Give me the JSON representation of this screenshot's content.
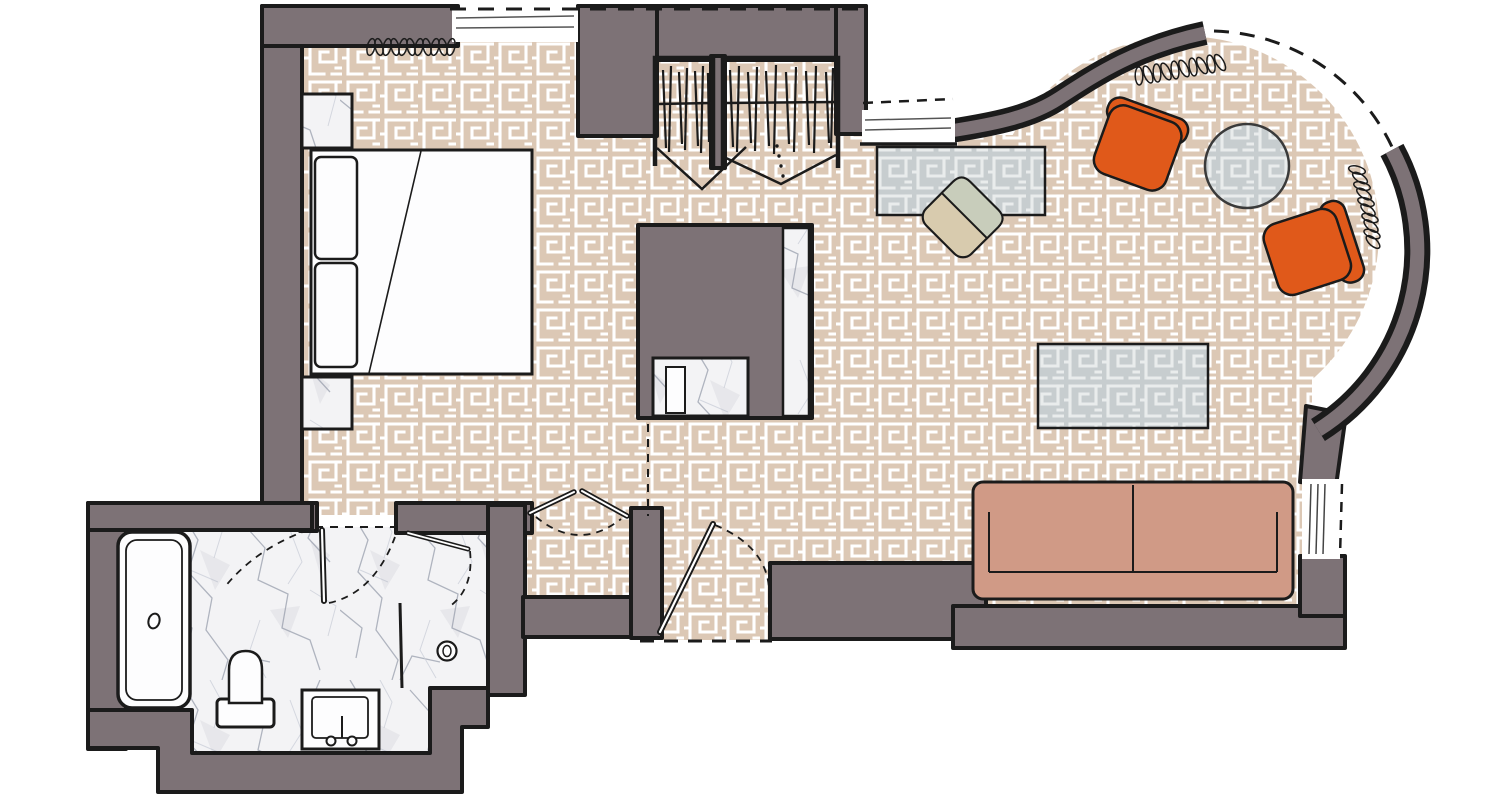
{
  "scene": {
    "kind": "hotel-suite-floor-plan",
    "rooms": [
      "bedroom",
      "wardrobes",
      "hallway",
      "bathroom",
      "living-room",
      "bay-lounge"
    ]
  },
  "colors": {
    "canvas_bg": "#ffffff",
    "wall": "#7d7276",
    "outline": "#1b1b1b",
    "carpet_bg": "#dcc8b5",
    "carpet_line": "#ffffff",
    "glass_bg": "#c7cdcf",
    "glass_line": "#e9ecec",
    "marble_bg": "#f3f3f5",
    "marble_vein": "#a8adb9",
    "marble_vein_light": "#ccd0da",
    "orange_chair": "#e0591a",
    "sofa": "#d09a86",
    "desk_chair_seat": "#d8cbae",
    "desk_chair_back": "#c8cdbb",
    "fixture_white": "#fdfdfe",
    "glass_table_stroke": "#3a3a3a"
  },
  "furniture": {
    "bedroom": [
      "double-bed",
      "pillow",
      "pillow",
      "nightstand",
      "nightstand",
      "curtain-coil"
    ],
    "wardrobes": [
      "hanging-clothes",
      "hanging-clothes",
      "bifold-doors"
    ],
    "core": [
      "fireplace-column",
      "marble-ledge",
      "minibar-niche"
    ],
    "living_room": [
      "writing-desk",
      "desk-chair",
      "glass-coffee-table",
      "two-seat-sofa"
    ],
    "bay_lounge": [
      "armchair",
      "armchair",
      "round-side-table",
      "curtain-coil",
      "curtain-coil"
    ],
    "bathroom": [
      "bathtub",
      "toilet",
      "vanity-sink",
      "shower-drain",
      "glass-partition"
    ]
  }
}
